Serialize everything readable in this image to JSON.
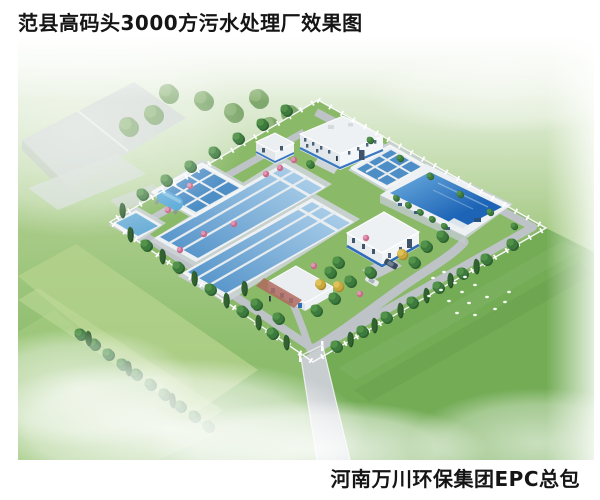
{
  "title": "范县高码头3000方污水处理厂效果图",
  "footer": "河南万川环保集团EPC总包",
  "rendering": {
    "colors": {
      "grass_inside": "#8ab968",
      "field_outside": "#9cc47e",
      "lawn_dark": "#73ac55",
      "pool_deep_blue": "#1d64b6",
      "lane_water_blue": "#4e8fc7",
      "road_gray": "#bdc3c7",
      "roof_white": "#eef1f3",
      "accent_blue": "#3a78c2",
      "fence_white": "#ffffff",
      "brick_red": "#b06a5e"
    }
  }
}
